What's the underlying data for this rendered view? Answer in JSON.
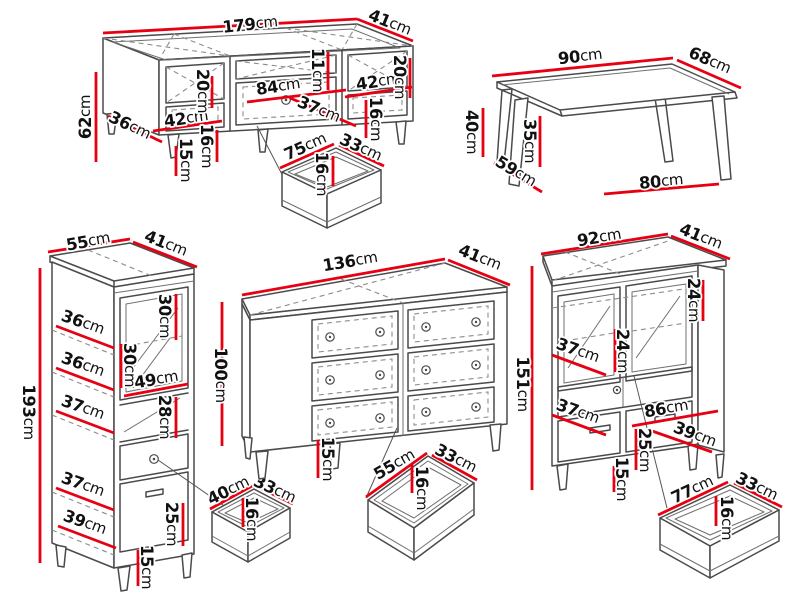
{
  "colors": {
    "dimension_line": "#e60012",
    "artwork_line": "#4a4a4a",
    "hidden_line": "#8c8c8c",
    "label_text": "#111111",
    "background": "#ffffff"
  },
  "pieces": [
    {
      "id": "tv-stand",
      "dimension_labels": [
        {
          "value": "179",
          "unit": "cm",
          "x": 250,
          "y": 24,
          "rot": -6
        },
        {
          "value": "41",
          "unit": "cm",
          "x": 390,
          "y": 22,
          "rot": 22
        },
        {
          "value": "62",
          "unit": "cm",
          "x": 85,
          "y": 117,
          "rot": -90
        },
        {
          "value": "36",
          "unit": "cm",
          "x": 130,
          "y": 125,
          "rot": 26
        },
        {
          "value": "42",
          "unit": "cm",
          "x": 186,
          "y": 118,
          "rot": -8
        },
        {
          "value": "20",
          "unit": "cm",
          "x": 203,
          "y": 91,
          "rot": 90
        },
        {
          "value": "16",
          "unit": "cm",
          "x": 207,
          "y": 146,
          "rot": 90
        },
        {
          "value": "15",
          "unit": "cm",
          "x": 186,
          "y": 160,
          "rot": 90
        },
        {
          "value": "84",
          "unit": "cm",
          "x": 278,
          "y": 86,
          "rot": -8
        },
        {
          "value": "11",
          "unit": "cm",
          "x": 318,
          "y": 70,
          "rot": 90
        },
        {
          "value": "37",
          "unit": "cm",
          "x": 319,
          "y": 109,
          "rot": 23
        },
        {
          "value": "42",
          "unit": "cm",
          "x": 378,
          "y": 81,
          "rot": -8
        },
        {
          "value": "20",
          "unit": "cm",
          "x": 400,
          "y": 77,
          "rot": 90
        },
        {
          "value": "16",
          "unit": "cm",
          "x": 376,
          "y": 119,
          "rot": 90
        }
      ],
      "dimension_lines": [
        [
          103,
          33,
          357,
          19
        ],
        [
          357,
          19,
          413,
          41
        ],
        [
          96,
          72,
          96,
          162
        ],
        [
          108,
          116,
          162,
          142
        ],
        [
          153,
          131,
          222,
          121
        ],
        [
          212,
          76,
          212,
          108
        ],
        [
          217,
          130,
          217,
          162
        ],
        [
          176,
          146,
          176,
          176
        ],
        [
          247,
          102,
          346,
          90
        ],
        [
          328,
          52,
          328,
          90
        ],
        [
          290,
          98,
          356,
          126
        ],
        [
          345,
          97,
          412,
          87
        ],
        [
          410,
          58,
          410,
          98
        ],
        [
          366,
          100,
          366,
          138
        ]
      ]
    },
    {
      "id": "tv-stand-drawer",
      "dimension_labels": [
        {
          "value": "75",
          "unit": "cm",
          "x": 305,
          "y": 146,
          "rot": -24
        },
        {
          "value": "33",
          "unit": "cm",
          "x": 361,
          "y": 147,
          "rot": 25
        },
        {
          "value": "16",
          "unit": "cm",
          "x": 322,
          "y": 174,
          "rot": 90
        }
      ],
      "dimension_lines": [
        [
          280,
          168,
          334,
          144
        ],
        [
          339,
          145,
          384,
          166
        ],
        [
          333,
          156,
          333,
          186
        ]
      ]
    },
    {
      "id": "coffee-table",
      "dimension_labels": [
        {
          "value": "90",
          "unit": "cm",
          "x": 580,
          "y": 56,
          "rot": -6
        },
        {
          "value": "68",
          "unit": "cm",
          "x": 710,
          "y": 60,
          "rot": 24
        },
        {
          "value": "40",
          "unit": "cm",
          "x": 472,
          "y": 132,
          "rot": 90
        },
        {
          "value": "59",
          "unit": "cm",
          "x": 516,
          "y": 171,
          "rot": 31
        },
        {
          "value": "35",
          "unit": "cm",
          "x": 530,
          "y": 141,
          "rot": 90
        },
        {
          "value": "80",
          "unit": "cm",
          "x": 661,
          "y": 181,
          "rot": -5
        }
      ],
      "dimension_lines": [
        [
          492,
          76,
          673,
          58
        ],
        [
          677,
          60,
          741,
          88
        ],
        [
          483,
          108,
          483,
          157
        ],
        [
          494,
          163,
          542,
          192
        ],
        [
          540,
          116,
          540,
          167
        ],
        [
          604,
          194,
          719,
          184
        ]
      ]
    },
    {
      "id": "display-cabinet",
      "dimension_labels": [
        {
          "value": "55",
          "unit": "cm",
          "x": 88,
          "y": 241,
          "rot": -10
        },
        {
          "value": "41",
          "unit": "cm",
          "x": 166,
          "y": 243,
          "rot": 22
        },
        {
          "value": "193",
          "unit": "cm",
          "x": 29,
          "y": 412,
          "rot": 90
        },
        {
          "value": "36",
          "unit": "cm",
          "x": 83,
          "y": 322,
          "rot": 20
        },
        {
          "value": "30",
          "unit": "cm",
          "x": 165,
          "y": 316,
          "rot": 90
        },
        {
          "value": "30",
          "unit": "cm",
          "x": 130,
          "y": 365,
          "rot": 90
        },
        {
          "value": "36",
          "unit": "cm",
          "x": 83,
          "y": 364,
          "rot": 20
        },
        {
          "value": "49",
          "unit": "cm",
          "x": 156,
          "y": 379,
          "rot": -9
        },
        {
          "value": "28",
          "unit": "cm",
          "x": 165,
          "y": 417,
          "rot": 90
        },
        {
          "value": "37",
          "unit": "cm",
          "x": 83,
          "y": 407,
          "rot": 20
        },
        {
          "value": "37",
          "unit": "cm",
          "x": 83,
          "y": 484,
          "rot": 20
        },
        {
          "value": "25",
          "unit": "cm",
          "x": 172,
          "y": 524,
          "rot": 90
        },
        {
          "value": "39",
          "unit": "cm",
          "x": 85,
          "y": 522,
          "rot": 20
        },
        {
          "value": "15",
          "unit": "cm",
          "x": 147,
          "y": 567,
          "rot": 90
        }
      ],
      "dimension_lines": [
        [
          48,
          252,
          130,
          239
        ],
        [
          133,
          242,
          197,
          267
        ],
        [
          40,
          268,
          40,
          563
        ],
        [
          56,
          326,
          114,
          348
        ],
        [
          176,
          294,
          176,
          340
        ],
        [
          121,
          344,
          121,
          388
        ],
        [
          56,
          368,
          114,
          390
        ],
        [
          124,
          396,
          188,
          384
        ],
        [
          176,
          397,
          176,
          438
        ],
        [
          56,
          411,
          114,
          433
        ],
        [
          56,
          488,
          114,
          510
        ],
        [
          183,
          503,
          183,
          546
        ],
        [
          58,
          526,
          116,
          548
        ],
        [
          138,
          550,
          138,
          586
        ]
      ]
    },
    {
      "id": "display-cabinet-drawer",
      "dimension_labels": [
        {
          "value": "40",
          "unit": "cm",
          "x": 228,
          "y": 490,
          "rot": -26
        },
        {
          "value": "33",
          "unit": "cm",
          "x": 275,
          "y": 489,
          "rot": 25
        },
        {
          "value": "16",
          "unit": "cm",
          "x": 252,
          "y": 519,
          "rot": 90
        }
      ],
      "dimension_lines": [
        [
          210,
          509,
          252,
          486
        ],
        [
          258,
          487,
          293,
          504
        ],
        [
          243,
          498,
          243,
          527
        ]
      ]
    },
    {
      "id": "dresser",
      "dimension_labels": [
        {
          "value": "136",
          "unit": "cm",
          "x": 350,
          "y": 261,
          "rot": -9
        },
        {
          "value": "41",
          "unit": "cm",
          "x": 480,
          "y": 257,
          "rot": 22
        },
        {
          "value": "100",
          "unit": "cm",
          "x": 221,
          "y": 375,
          "rot": 90
        },
        {
          "value": "15",
          "unit": "cm",
          "x": 328,
          "y": 459,
          "rot": 90
        }
      ],
      "dimension_lines": [
        [
          242,
          295,
          445,
          259
        ],
        [
          448,
          260,
          510,
          285
        ],
        [
          222,
          302,
          222,
          446
        ],
        [
          318,
          440,
          318,
          478
        ]
      ]
    },
    {
      "id": "dresser-drawer",
      "dimension_labels": [
        {
          "value": "55",
          "unit": "cm",
          "x": 394,
          "y": 464,
          "rot": -30
        },
        {
          "value": "33",
          "unit": "cm",
          "x": 456,
          "y": 458,
          "rot": 27
        },
        {
          "value": "16",
          "unit": "cm",
          "x": 422,
          "y": 488,
          "rot": 90
        }
      ],
      "dimension_lines": [
        [
          366,
          497,
          427,
          453
        ],
        [
          432,
          455,
          477,
          480
        ],
        [
          412,
          464,
          412,
          493
        ]
      ]
    },
    {
      "id": "highboard",
      "dimension_labels": [
        {
          "value": "92",
          "unit": "cm",
          "x": 599,
          "y": 237,
          "rot": -9
        },
        {
          "value": "41",
          "unit": "cm",
          "x": 701,
          "y": 236,
          "rot": 22
        },
        {
          "value": "151",
          "unit": "cm",
          "x": 523,
          "y": 384,
          "rot": 90
        },
        {
          "value": "24",
          "unit": "cm",
          "x": 623,
          "y": 351,
          "rot": 90
        },
        {
          "value": "24",
          "unit": "cm",
          "x": 694,
          "y": 300,
          "rot": 90
        },
        {
          "value": "37",
          "unit": "cm",
          "x": 578,
          "y": 350,
          "rot": 20
        },
        {
          "value": "37",
          "unit": "cm",
          "x": 578,
          "y": 411,
          "rot": 20
        },
        {
          "value": "86",
          "unit": "cm",
          "x": 666,
          "y": 408,
          "rot": -9
        },
        {
          "value": "39",
          "unit": "cm",
          "x": 695,
          "y": 434,
          "rot": 21
        },
        {
          "value": "25",
          "unit": "cm",
          "x": 645,
          "y": 450,
          "rot": 90
        },
        {
          "value": "15",
          "unit": "cm",
          "x": 622,
          "y": 479,
          "rot": 90
        }
      ],
      "dimension_lines": [
        [
          541,
          254,
          668,
          234
        ],
        [
          671,
          236,
          730,
          259
        ],
        [
          532,
          266,
          532,
          490
        ],
        [
          615,
          329,
          615,
          372
        ],
        [
          703,
          280,
          703,
          321
        ],
        [
          552,
          355,
          606,
          375
        ],
        [
          552,
          415,
          606,
          435
        ],
        [
          632,
          426,
          718,
          411
        ],
        [
          652,
          431,
          712,
          452
        ],
        [
          636,
          429,
          636,
          470
        ],
        [
          614,
          466,
          614,
          492
        ]
      ]
    },
    {
      "id": "highboard-drawer",
      "dimension_labels": [
        {
          "value": "77",
          "unit": "cm",
          "x": 692,
          "y": 489,
          "rot": -25
        },
        {
          "value": "33",
          "unit": "cm",
          "x": 757,
          "y": 486,
          "rot": 26
        },
        {
          "value": "16",
          "unit": "cm",
          "x": 727,
          "y": 518,
          "rot": 90
        }
      ],
      "dimension_lines": [
        [
          658,
          515,
          728,
          482
        ],
        [
          734,
          483,
          782,
          507
        ],
        [
          716,
          496,
          716,
          526
        ]
      ]
    }
  ]
}
